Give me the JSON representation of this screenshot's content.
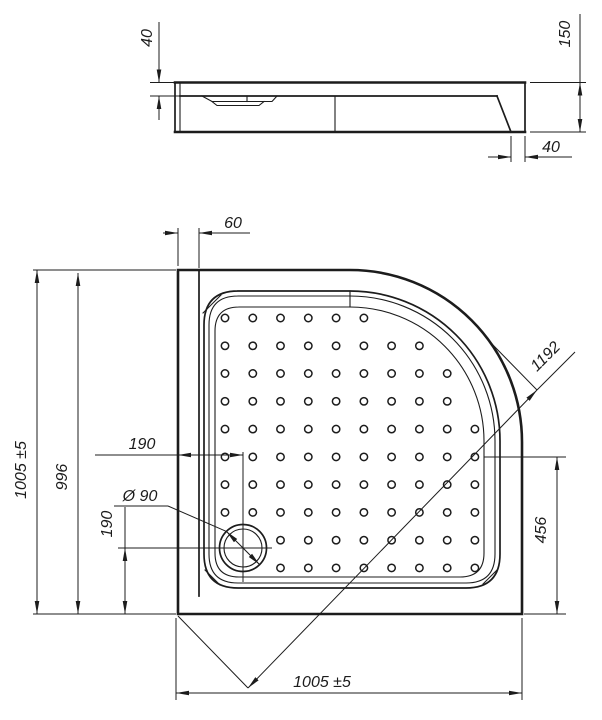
{
  "drawing": {
    "title": "Quadrant shower tray technical drawing",
    "views": [
      "side elevation",
      "plan"
    ],
    "line_color": "#1c1c1c",
    "background_color": "#ffffff"
  },
  "side_view": {
    "dim_rim_height": "40",
    "dim_total_height": "150",
    "dim_wall_offset": "40"
  },
  "plan_view": {
    "dim_flange_width": "60",
    "dim_height_overall": "1005 ±5",
    "dim_height_inner": "996",
    "dim_drain_from_left": "190",
    "dim_drain_diameter": "Ø 90",
    "dim_drain_from_bottom": "190",
    "dim_diagonal": "1192",
    "dim_corner_to_bottom": "456",
    "dim_width_overall": "1005 ±5",
    "dots": {
      "origin_x": 225,
      "origin_y": 318,
      "step": 27.77,
      "cols": 10,
      "rows": 10,
      "radius": 3.7,
      "arc_cx": 350,
      "arc_cy": 441,
      "arc_limit": 127,
      "drain_cx": 243,
      "drain_cy": 548,
      "drain_clear": 30,
      "right_limit": 478,
      "bottom_limit": 572
    }
  }
}
